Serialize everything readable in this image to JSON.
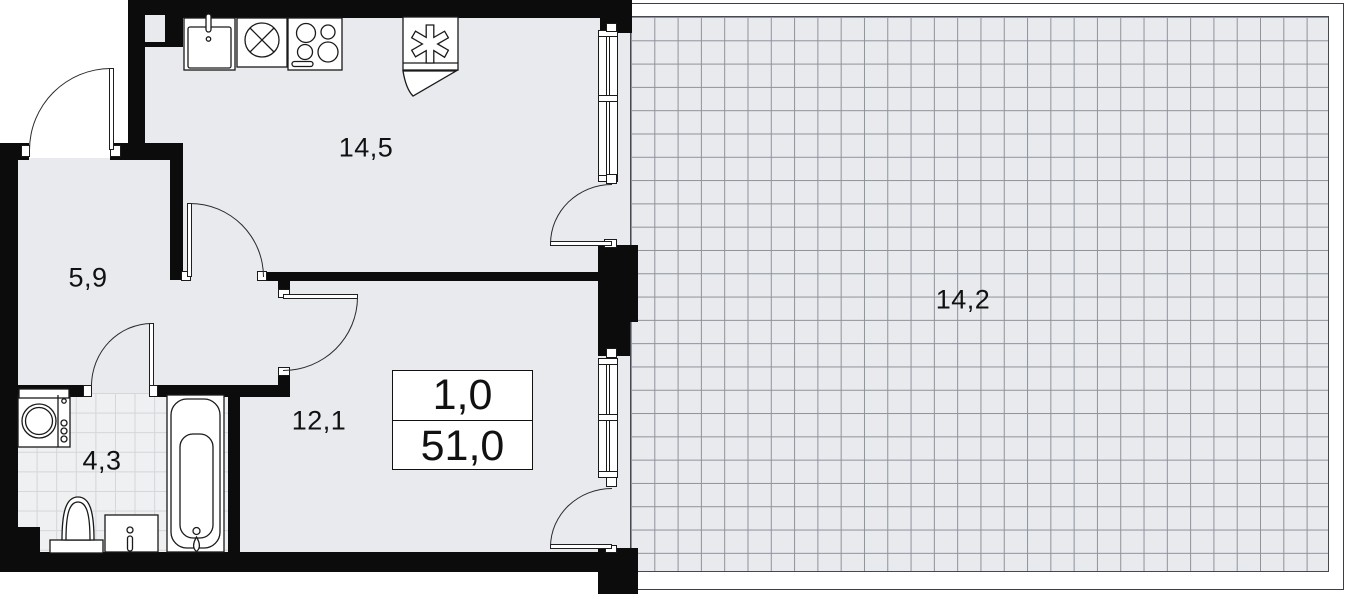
{
  "info_box": {
    "rooms": "1,0",
    "total_area": "51,0"
  },
  "rooms": {
    "kitchen": {
      "label": "14,5"
    },
    "hallway": {
      "label": "5,9"
    },
    "bathroom": {
      "label": "4,3"
    },
    "living_room": {
      "label": "12,1"
    },
    "terrace": {
      "label": "14,2"
    }
  },
  "fixtures": {
    "kitchen": [
      "sink",
      "hob-cross",
      "stove",
      "fridge-freezer"
    ],
    "bathroom": [
      "washing-machine",
      "toilet",
      "vanity-sink",
      "bathtub"
    ]
  },
  "colors": {
    "floor": "#e8eaed",
    "wall": "#0c0c0c",
    "outline": "#3a3e45",
    "terrace_grid_line": "#8d929b",
    "bath_tile_line": "#d3d6da"
  }
}
